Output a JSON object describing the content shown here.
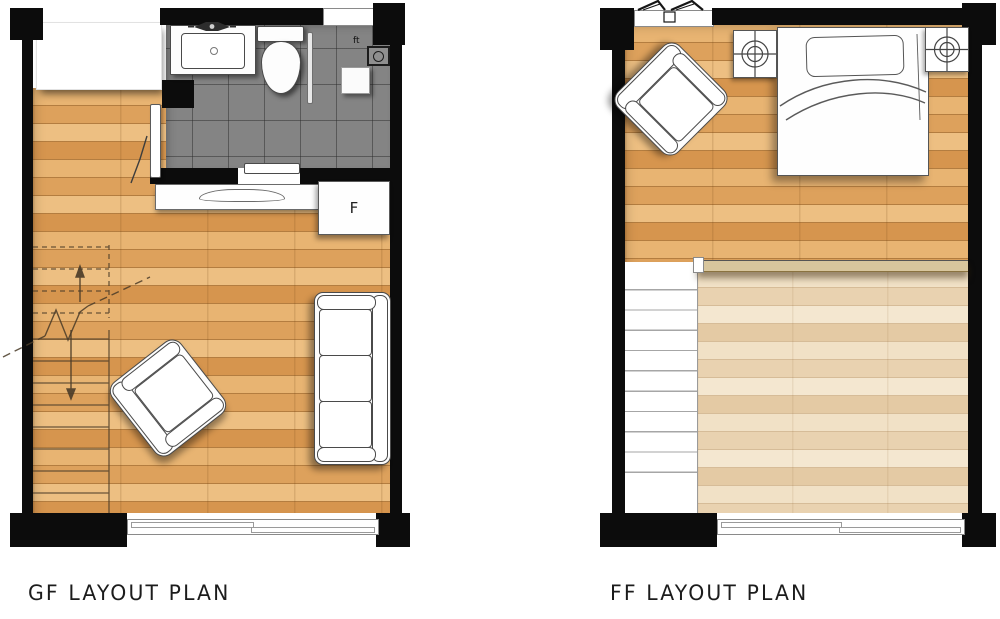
{
  "captions": {
    "gf": "GF LAYOUT PLAN",
    "ff": "FF LAYOUT PLAN"
  },
  "labels": {
    "fridge": "F",
    "floor_trap": "ft"
  },
  "colors": {
    "wall": "#0c0c0c",
    "wood_floor": "#e0a65f",
    "wood_floor_light": "#edd9bb",
    "bathroom_tile": "#848484",
    "furniture_fill": "#fdfdfd",
    "furniture_outline": "#4a4a4a",
    "railing": "#d8c69d",
    "caption_text": "#1c1c1c"
  },
  "icons": {
    "faucet": "faucet-icon",
    "floor_trap": "floor-trap-icon",
    "table_lamp": "table-lamp-icon",
    "casement_window": "casement-window-icon",
    "stair_up_arrow": "stair-up-arrow-icon",
    "stair_down_arrow": "stair-down-arrow-icon"
  }
}
